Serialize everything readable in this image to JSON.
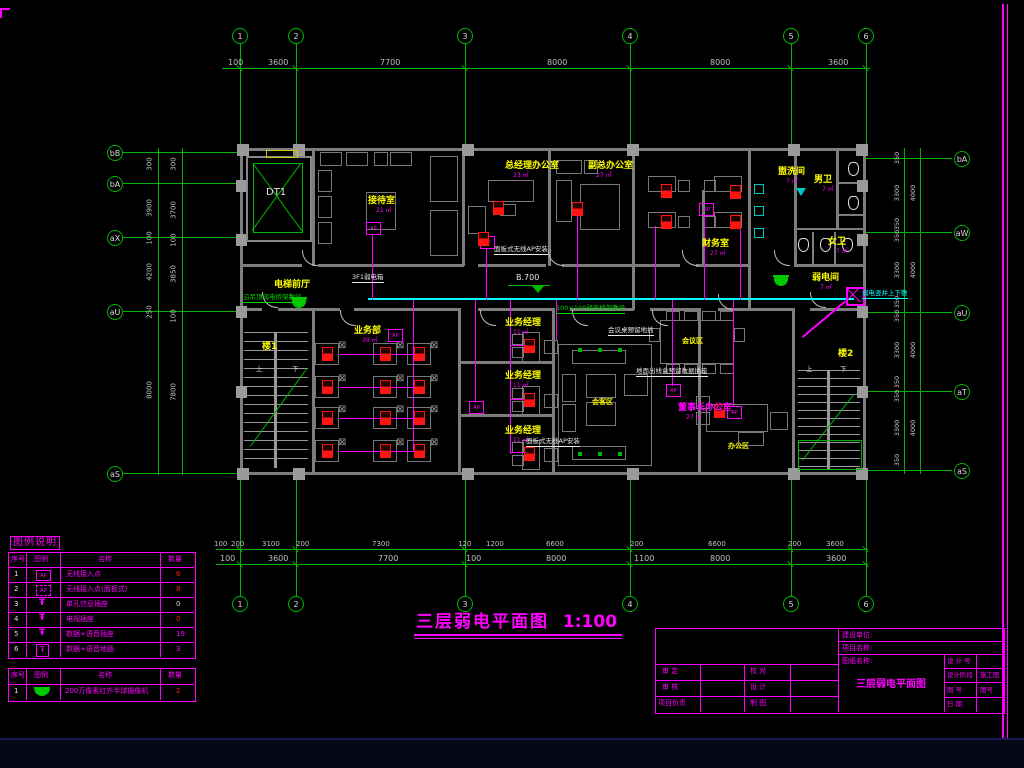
{
  "sheet": {
    "title": "三层弱电平面图",
    "scale": "1:100"
  },
  "colors": {
    "grid": "#00b400",
    "dim": "#c0c0c0",
    "wall": "#7d7d7d",
    "room": "#ffff00",
    "area": "#ff00ff",
    "device": "#ff1414",
    "wire": "#ff00ff",
    "trunk": "#00ffff",
    "note": "#e8e8e8",
    "frame": "#ff00ff",
    "furn": "#8a8a8a"
  },
  "grid": {
    "cols": {
      "labels": [
        "1",
        "2",
        "3",
        "4",
        "5",
        "6"
      ],
      "x": [
        240,
        296,
        465,
        630,
        791,
        866
      ]
    },
    "top_dims": [
      [
        "100",
        228
      ],
      [
        "3600",
        268
      ],
      [
        "7700",
        380
      ],
      [
        "8000",
        547
      ],
      [
        "8000",
        710
      ],
      [
        "3600",
        828
      ]
    ],
    "bot1_dims": [
      [
        "100",
        214
      ],
      [
        "200",
        231
      ],
      [
        "3100",
        262
      ],
      [
        "200",
        296
      ],
      [
        "7300",
        372
      ],
      [
        "120",
        458
      ],
      [
        "1200",
        486
      ],
      [
        "6600",
        546
      ],
      [
        "200",
        630
      ],
      [
        "6600",
        708
      ],
      [
        "200",
        788
      ],
      [
        "3600",
        826
      ]
    ],
    "bot2_dims": [
      [
        "100",
        220
      ],
      [
        "3600",
        268
      ],
      [
        "7700",
        378
      ],
      [
        "100",
        466
      ],
      [
        "8000",
        546
      ],
      [
        "1100",
        634
      ],
      [
        "8000",
        710
      ],
      [
        "3600",
        826
      ]
    ],
    "left": {
      "labels": [
        "bB",
        "bA",
        "aX",
        "aU",
        "aS"
      ],
      "y": [
        152,
        183,
        237,
        311,
        473
      ]
    },
    "right": {
      "labels": [
        "bA",
        "aW",
        "aU",
        "aT",
        "aS"
      ],
      "y": [
        158,
        232,
        312,
        391,
        470
      ]
    },
    "left_dims_a": [
      [
        "300",
        164
      ],
      [
        "3900",
        208
      ],
      [
        "100",
        238
      ],
      [
        "4200",
        272
      ],
      [
        "250",
        312
      ],
      [
        "8000",
        390
      ]
    ],
    "left_dims_b": [
      [
        "300",
        164
      ],
      [
        "3700",
        210
      ],
      [
        "100",
        240
      ],
      [
        "3850",
        274
      ],
      [
        "100",
        316
      ],
      [
        "7800",
        392
      ]
    ],
    "right_dims_a": [
      [
        "350",
        158
      ],
      [
        "3300",
        193
      ],
      [
        "350",
        224
      ],
      [
        "350",
        236
      ],
      [
        "3300",
        270
      ],
      [
        "350",
        302
      ],
      [
        "350",
        316
      ],
      [
        "3300",
        350
      ],
      [
        "350",
        382
      ],
      [
        "350",
        396
      ],
      [
        "3300",
        428
      ],
      [
        "350",
        460
      ]
    ],
    "right_dims_b": [
      [
        "4000",
        193
      ],
      [
        "4000",
        270
      ],
      [
        "4000",
        350
      ],
      [
        "4000",
        428
      ]
    ]
  },
  "elevator": {
    "label": "DT1"
  },
  "elevation": {
    "label": "B.700"
  },
  "rooms": [
    {
      "name": "接待室",
      "area": "21 ㎡",
      "x": 368,
      "y": 197,
      "color": "#ffff00"
    },
    {
      "name": "总经理办公室",
      "area": "23 ㎡",
      "x": 505,
      "y": 162,
      "color": "#ffff00"
    },
    {
      "name": "副总办公室",
      "area": "27 ㎡",
      "x": 588,
      "y": 162,
      "color": "#ffff00"
    },
    {
      "name": "财务室",
      "area": "27 ㎡",
      "x": 702,
      "y": 240,
      "color": "#ffff00"
    },
    {
      "name": "盥洗间",
      "area": "7 ㎡",
      "x": 778,
      "y": 168,
      "color": "#ffff00"
    },
    {
      "name": "男卫",
      "area": "7 ㎡",
      "x": 814,
      "y": 176,
      "color": "#ffff00"
    },
    {
      "name": "女卫",
      "area": "7 ㎡",
      "x": 828,
      "y": 238,
      "color": "#ffff00"
    },
    {
      "name": "弱电间",
      "area": "7 ㎡",
      "x": 812,
      "y": 274,
      "color": "#ffff00"
    },
    {
      "name": "电梯前厅",
      "x": 274,
      "y": 281,
      "color": "#ffff00"
    },
    {
      "name": "业务部",
      "area": "39 ㎡",
      "x": 354,
      "y": 327,
      "color": "#ffff00"
    },
    {
      "name": "业务经理",
      "area": "11 ㎡",
      "x": 505,
      "y": 319,
      "color": "#ffff00"
    },
    {
      "name": "业务经理",
      "area": "11 ㎡",
      "x": 505,
      "y": 372,
      "color": "#ffff00"
    },
    {
      "name": "业务经理",
      "area": "11 ㎡",
      "x": 505,
      "y": 427,
      "color": "#ffff00"
    },
    {
      "name": "董事长办公室",
      "area": "27 ㎡",
      "x": 678,
      "y": 404,
      "color": "#ff00ff"
    },
    {
      "name": "会客区",
      "x": 592,
      "y": 399,
      "color": "#ffff00",
      "small": true
    },
    {
      "name": "会议区",
      "x": 682,
      "y": 338,
      "color": "#ffff00",
      "small": true
    },
    {
      "name": "办公区",
      "x": 728,
      "y": 443,
      "color": "#ffff00",
      "small": true
    },
    {
      "name": "楼1",
      "x": 262,
      "y": 343,
      "color": "#ffff00"
    },
    {
      "name": "楼2",
      "x": 838,
      "y": 350,
      "color": "#ffff00"
    }
  ],
  "annotations": [
    {
      "text": "沿吊顶弱电桥架敷设",
      "x": 243,
      "y": 294,
      "color": "#00d200",
      "underline": true
    },
    {
      "text": "100×100弱电桥架敷设",
      "x": 556,
      "y": 305,
      "color": "#00d200",
      "underline": true
    },
    {
      "text": "弱电竖井上下敷",
      "x": 862,
      "y": 290,
      "color": "#00ffff",
      "underline": true
    },
    {
      "text": "3F1弱电箱",
      "x": 352,
      "y": 274,
      "color": "#e8e8e8",
      "underline": true
    },
    {
      "text": "面板式无线AP安装",
      "x": 494,
      "y": 246,
      "color": "#e8e8e8",
      "underline": true
    },
    {
      "text": "会议桌预留地插",
      "x": 608,
      "y": 327,
      "color": "#e8e8e8",
      "underline": true
    },
    {
      "text": "地面出线盒预留数据插座",
      "x": 636,
      "y": 368,
      "color": "#e8e8e8",
      "underline": true
    },
    {
      "text": "面板式无线AP安装",
      "x": 526,
      "y": 438,
      "color": "#e8e8e8",
      "underline": true
    },
    {
      "text": "上",
      "x": 256,
      "y": 366,
      "color": "#dddddd"
    },
    {
      "text": "下",
      "x": 292,
      "y": 366,
      "color": "#dddddd"
    },
    {
      "text": "上",
      "x": 806,
      "y": 366,
      "color": "#dddddd"
    },
    {
      "text": "下",
      "x": 840,
      "y": 366,
      "color": "#dddddd"
    }
  ],
  "devices": [
    {
      "type": "camera",
      "x": 292,
      "y": 299
    },
    {
      "type": "camera",
      "x": 774,
      "y": 277
    },
    {
      "type": "riser",
      "x": 846,
      "y": 287
    },
    {
      "type": "ap",
      "x": 366,
      "y": 222
    },
    {
      "type": "ap",
      "x": 480,
      "y": 236
    },
    {
      "type": "ap",
      "x": 388,
      "y": 329
    },
    {
      "type": "ap",
      "x": 469,
      "y": 401
    },
    {
      "type": "ap",
      "x": 666,
      "y": 384
    },
    {
      "type": "ap",
      "x": 699,
      "y": 203
    },
    {
      "type": "ap",
      "x": 727,
      "y": 406
    },
    {
      "type": "outlet",
      "x": 493,
      "y": 201
    },
    {
      "type": "outlet",
      "x": 478,
      "y": 232
    },
    {
      "type": "outlet",
      "x": 572,
      "y": 202
    },
    {
      "type": "outlet",
      "x": 661,
      "y": 184
    },
    {
      "type": "outlet",
      "x": 661,
      "y": 215
    },
    {
      "type": "outlet",
      "x": 730,
      "y": 185
    },
    {
      "type": "outlet",
      "x": 730,
      "y": 215
    },
    {
      "type": "outlet",
      "x": 322,
      "y": 347
    },
    {
      "type": "outlet",
      "x": 380,
      "y": 347
    },
    {
      "type": "outlet",
      "x": 414,
      "y": 347
    },
    {
      "type": "outlet",
      "x": 322,
      "y": 380
    },
    {
      "type": "outlet",
      "x": 380,
      "y": 380
    },
    {
      "type": "outlet",
      "x": 414,
      "y": 380
    },
    {
      "type": "outlet",
      "x": 322,
      "y": 411
    },
    {
      "type": "outlet",
      "x": 380,
      "y": 411
    },
    {
      "type": "outlet",
      "x": 414,
      "y": 411
    },
    {
      "type": "outlet",
      "x": 322,
      "y": 444
    },
    {
      "type": "outlet",
      "x": 380,
      "y": 444
    },
    {
      "type": "outlet",
      "x": 414,
      "y": 444
    },
    {
      "type": "outlet",
      "x": 524,
      "y": 339
    },
    {
      "type": "outlet",
      "x": 524,
      "y": 393
    },
    {
      "type": "outlet",
      "x": 524,
      "y": 447
    },
    {
      "type": "outlet",
      "x": 714,
      "y": 404
    }
  ],
  "legend": {
    "title": "图例说明",
    "headers": [
      "序号",
      "图例",
      "名称",
      "数量"
    ],
    "rows": [
      {
        "no": "1",
        "icon": "ap-box",
        "name": "无线接入点",
        "qty": "6",
        "qcolor": "#ff2020"
      },
      {
        "no": "2",
        "icon": "ap-panel",
        "name": "无线接入点(面板式)",
        "qty": "8",
        "qcolor": "#ff2020"
      },
      {
        "no": "3",
        "icon": "tpole",
        "name": "单孔信息插座",
        "qty": "0",
        "qcolor": "#dddddd"
      },
      {
        "no": "4",
        "icon": "tpole",
        "name": "电视插座",
        "qty": "0",
        "qcolor": "#ff2020"
      },
      {
        "no": "5",
        "icon": "tpole",
        "name": "数据+语音插座",
        "qty": "19",
        "qcolor": "#ff00ff"
      },
      {
        "no": "6",
        "icon": "tpole-box",
        "name": "数据+语音地插",
        "qty": "3",
        "qcolor": "#ff00ff"
      }
    ],
    "table2_headers": [
      "序号",
      "图例",
      "名称",
      "数量"
    ],
    "table2_rows": [
      {
        "no": "1",
        "icon": "camera",
        "name": "200万像素红外半球摄像机",
        "qty": "2",
        "qcolor": "#ff2020"
      }
    ]
  },
  "titleblock": {
    "fields": {
      "jsdw": "建设单位:",
      "xmmc": "项目名称:",
      "tzmc": "图纸名称:"
    },
    "drawing_name": "三层弱电平面图",
    "left_labels": [
      "审  定",
      "审  核",
      "项目负责",
      "校  对",
      "设  计",
      "制  图"
    ],
    "right_rows": [
      {
        "label": "设 计 号",
        "value": ""
      },
      {
        "label": "设计阶段",
        "value": "施工图"
      },
      {
        "label": "图    号",
        "value": "图号"
      },
      {
        "label": "日    期",
        "value": ""
      }
    ]
  }
}
